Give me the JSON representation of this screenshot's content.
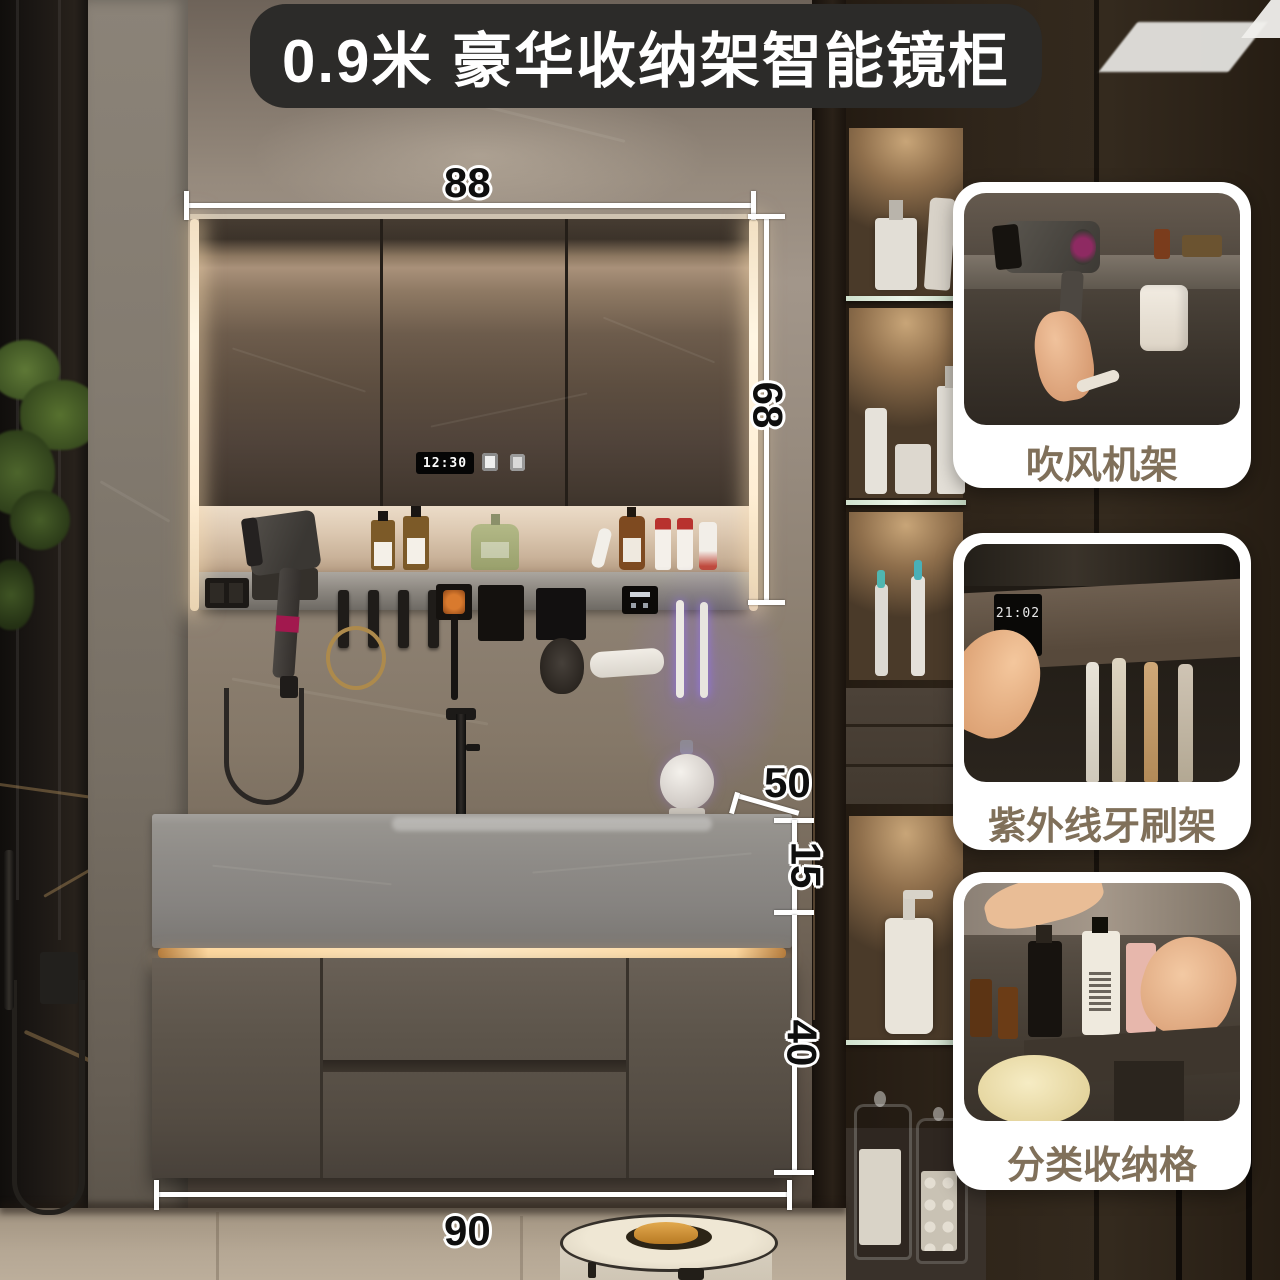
{
  "banner": {
    "title": "0.9米 豪华收纳架智能镜柜"
  },
  "dimensions": {
    "mirror_width": "88",
    "mirror_height": "68",
    "counter_depth": "50",
    "counter_thickness": "15",
    "cabinet_height": "40",
    "vanity_width": "90"
  },
  "mirror_cabinet": {
    "clock_time": "12:30"
  },
  "feature_cards": [
    {
      "label": "吹风机架"
    },
    {
      "label": "紫外线牙刷架",
      "display_time": "21:02"
    },
    {
      "label": "分类收纳格"
    }
  ],
  "colors": {
    "banner_bg": "#2c2b29",
    "banner_text": "#ffffff",
    "card_bg": "#ffffff",
    "card_label_text": "#80705a",
    "dimension_text": "#0e0e0e",
    "dimension_line": "#ffffff",
    "warm_led": "#ffeed4",
    "uv_glow": "#8d6bff",
    "magenta_accent": "#a2184e"
  }
}
